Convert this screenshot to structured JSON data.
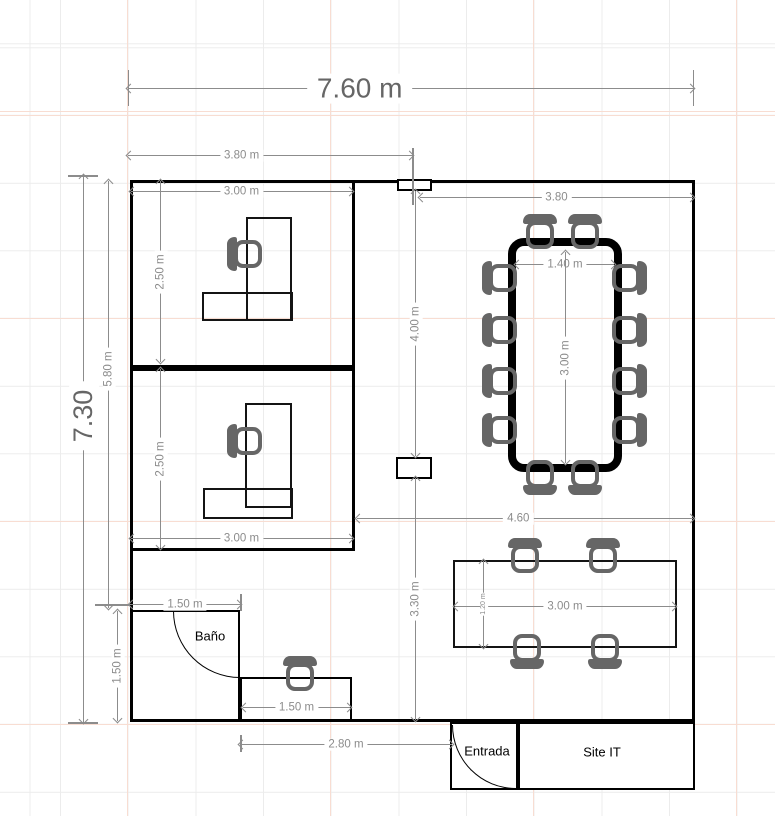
{
  "dims": {
    "total_width": "7.60 m",
    "total_height": "7.30",
    "left_wing_width": "3.80 m",
    "right_wing_width": "3.80",
    "office1_width": "3.00 m",
    "office1_depth": "2.50 m",
    "office2_width": "3.00 m",
    "office2_depth": "2.50 m",
    "offices_total_height": "5.80 m",
    "conference_table_width": "1.40 m",
    "conference_table_length": "3.00 m",
    "corridor_upper_height": "4.00 m",
    "corridor_lower_height": "3.30 m",
    "open_area_width": "4.60",
    "bano_width": "1.50 m",
    "bano_height": "1.50 m",
    "reception_desk_width": "1.50 m",
    "bottom_clearance_width": "2.80 m",
    "meeting_table_width": "3.00 m",
    "meeting_table_depth": "1.20 m"
  },
  "rooms": {
    "bano": "Baño",
    "entrada": "Entrada",
    "site_it": "Site IT"
  },
  "colors": {
    "wall": "#000000",
    "furniture": "#666666",
    "dimension": "#8c8c8c",
    "grid_minor": "#ececec",
    "grid_major": "#f8ddd2"
  }
}
